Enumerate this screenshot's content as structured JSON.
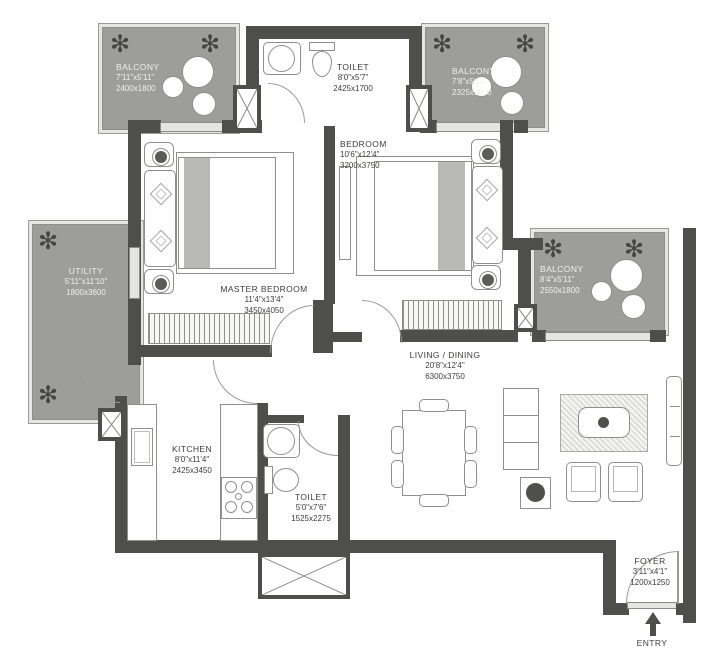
{
  "plan": {
    "title": "2 BHK apartment floor plan",
    "rooms": {
      "balcony_tl": {
        "name": "BALCONY",
        "dims_ft": "7'11\"x5'11\"",
        "dims_mm": "2400x1800"
      },
      "toilet_top": {
        "name": "TOILET",
        "dims_ft": "8'0\"x5'7\"",
        "dims_mm": "2425x1700"
      },
      "balcony_tr": {
        "name": "BALCONY",
        "dims_ft": "7'8\"x5'11\"",
        "dims_mm": "2325x1800"
      },
      "bedroom": {
        "name": "BEDROOM",
        "dims_ft": "10'6\"x12'4\"",
        "dims_mm": "3200x3750"
      },
      "master_bedroom": {
        "name": "MASTER BEDROOM",
        "dims_ft": "11'4\"x13'4\"",
        "dims_mm": "3450x4050"
      },
      "utility": {
        "name": "UTILITY",
        "dims_ft": "5'11\"x11'10\"",
        "dims_mm": "1800x3600"
      },
      "balcony_right": {
        "name": "BALCONY",
        "dims_ft": "8'4\"x5'11\"",
        "dims_mm": "2550x1800"
      },
      "living_dining": {
        "name": "LIVING / DINING",
        "dims_ft": "20'8\"x12'4\"",
        "dims_mm": "6300x3750"
      },
      "kitchen": {
        "name": "KITCHEN",
        "dims_ft": "8'0\"x11'4\"",
        "dims_mm": "2425x3450"
      },
      "toilet_bottom": {
        "name": "TOILET",
        "dims_ft": "5'0\"x7'6\"",
        "dims_mm": "1525x2275"
      },
      "foyer": {
        "name": "FOYER",
        "dims_ft": "3'11\"x4'1\"",
        "dims_mm": "1200x1250"
      }
    },
    "entry_label": "ENTRY",
    "plant_glyph": "✻",
    "colors": {
      "wall": "#4e4e4c",
      "balcony_fill": "#9d9d9b",
      "text_dark": "#3d3d3b",
      "text_light": "#efefec"
    }
  }
}
